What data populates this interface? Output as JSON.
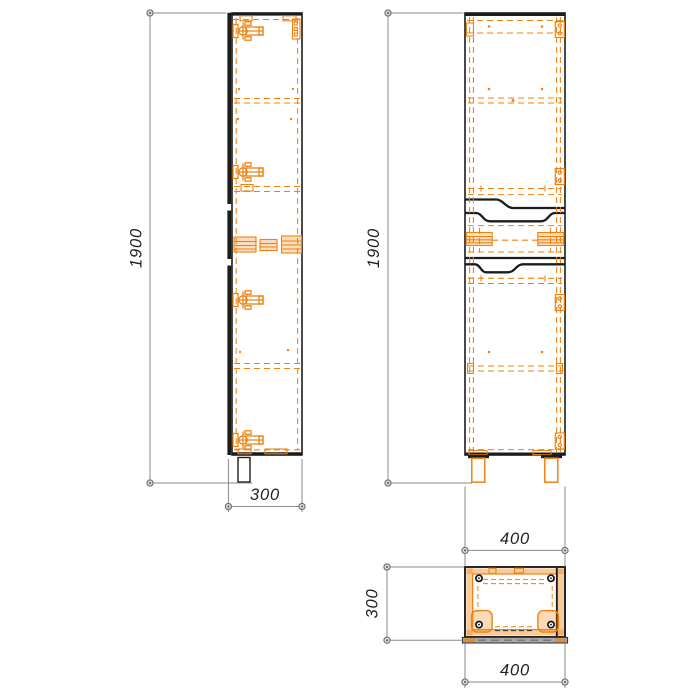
{
  "colors": {
    "line": "#1c1c1c",
    "hardware_orange": "#ef8312",
    "dimension_gray": "#8a8a8a",
    "background": "#ffffff"
  },
  "views": {
    "side": {
      "height": "1900",
      "depth": "300"
    },
    "front": {
      "height": "1900",
      "width": "400"
    },
    "top": {
      "depth": "300",
      "width": "400"
    }
  }
}
